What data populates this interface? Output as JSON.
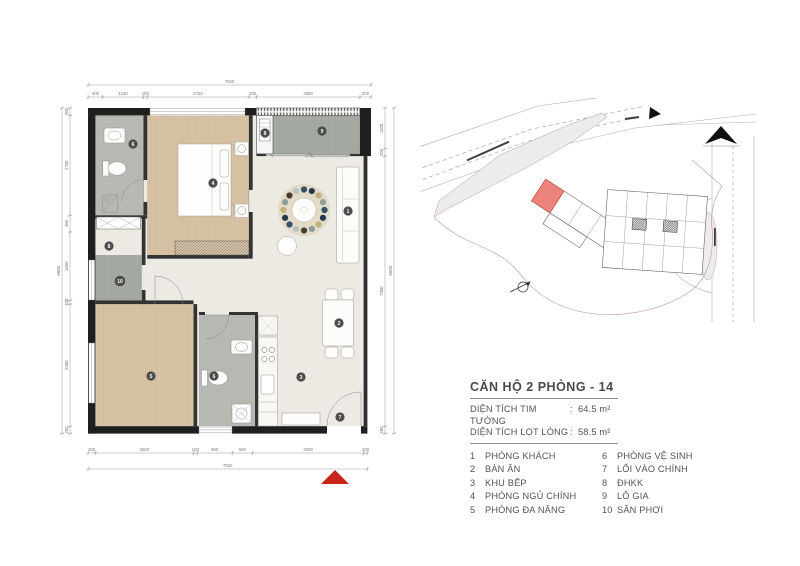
{
  "title_block": {
    "title": "CĂN HỘ 2 PHÒNG - 14",
    "area_rows": [
      {
        "label": "DIỆN TÍCH TIM TƯỜNG",
        "sep": ":",
        "value": "64.5 m²"
      },
      {
        "label": "DIỆN TÍCH LỌT LÒNG",
        "sep": ":",
        "value": "58.5 m²"
      }
    ],
    "legend_col1": [
      {
        "num": "1",
        "label": "PHÒNG KHÁCH"
      },
      {
        "num": "2",
        "label": "BÀN ĂN"
      },
      {
        "num": "3",
        "label": "KHU BẾP"
      },
      {
        "num": "4",
        "label": "PHÒNG NGỦ CHÍNH"
      },
      {
        "num": "5",
        "label": "PHÒNG ĐA NĂNG"
      }
    ],
    "legend_col2": [
      {
        "num": "6",
        "label": "PHÒNG VỆ SINH"
      },
      {
        "num": "7",
        "label": "LỐI VÀO CHÍNH"
      },
      {
        "num": "8",
        "label": "ĐHKK"
      },
      {
        "num": "9",
        "label": "LÔ GIA"
      },
      {
        "num": "10",
        "label": "SÂN PHƠI"
      }
    ]
  },
  "dimensions": {
    "top": {
      "overall": "7650",
      "segments": [
        "400",
        "1100",
        "100",
        "2750",
        "200",
        "2800",
        "300"
      ]
    },
    "bottom": {
      "overall": "7550",
      "segments": [
        "200",
        "2650",
        "100",
        "950",
        "550",
        "3000",
        "100"
      ]
    },
    "left": {
      "overall": "8800",
      "segments": [
        "200",
        "2700",
        "450",
        "1850",
        "100",
        "3300",
        "200"
      ]
    },
    "right": {
      "overall": "8800",
      "segments": [
        "1100",
        "200",
        "7300",
        "200"
      ]
    }
  },
  "markers": [
    "1",
    "2",
    "3",
    "4",
    "5",
    "6",
    "6",
    "7",
    "8",
    "8",
    "9",
    "10"
  ],
  "colors": {
    "unit_highlight": "#ec837c",
    "entrance_arrow": "#c9241b",
    "wood_floor": "#d9c4a7",
    "bathroom_tile": "#b6bab2",
    "balcony_tile": "#a4a9a2"
  }
}
